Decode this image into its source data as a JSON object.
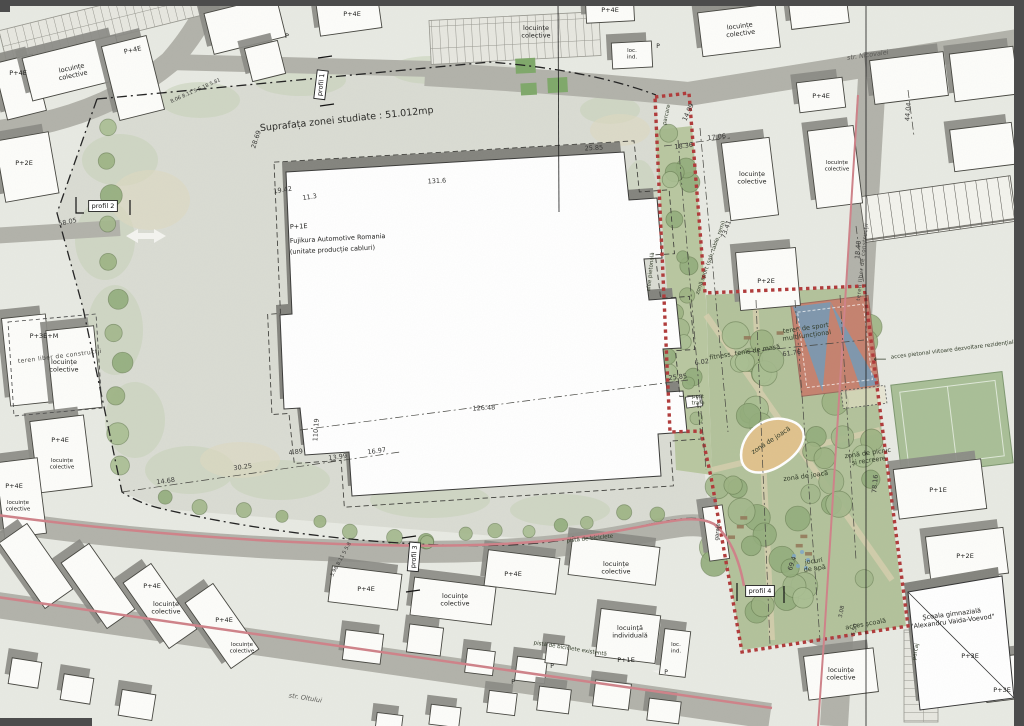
{
  "map": {
    "colors": {
      "boundary_red": "#b03a3a",
      "study_line": "#222222",
      "park_green": "#b3c29b",
      "tree_green": "#9db383",
      "road_gray": "#b2b2aa",
      "bike_path_pink": "#cf8289",
      "building_white": "#fdfdfa",
      "shadow_gray": "#8b8b85",
      "sand_tan": "#e0c28d",
      "sport_red": "#c5826f",
      "sport_blue": "#7f97ad"
    },
    "labels": [
      {
        "t": "Suprafața zonei studiate : 51.012mp",
        "x": 347,
        "y": 122,
        "rot": -6,
        "size": 9.5,
        "cls": "title",
        "name": "study-area-label"
      },
      {
        "t": "P+1E",
        "x": 290,
        "y": 229,
        "rot": -3,
        "anchor": "start",
        "cls": "bldg"
      },
      {
        "t": "Fujikura Automotive Romania",
        "x": 290,
        "y": 243,
        "rot": -3,
        "anchor": "start",
        "cls": "bldg",
        "name": "factory-name"
      },
      {
        "t": "(unitate producție cabluri)",
        "x": 290,
        "y": 254,
        "rot": -3,
        "anchor": "start",
        "cls": "bldg"
      },
      {
        "t": "str. Nicovalei",
        "x": 868,
        "y": 57,
        "rot": -8,
        "cls": "street",
        "name": "street-name-nicovalei"
      },
      {
        "t": "str. Oltului",
        "x": 305,
        "y": 700,
        "rot": 9,
        "cls": "street",
        "name": "street-name-oltului"
      },
      {
        "t": "profil 1",
        "x": 323,
        "y": 85,
        "rot": -83,
        "cls": "profil",
        "boxed": true,
        "name": "profile-marker-1"
      },
      {
        "t": "profil 2",
        "x": 103,
        "y": 208,
        "cls": "profil",
        "boxed": true,
        "name": "profile-marker-2"
      },
      {
        "t": "profil 3",
        "x": 416,
        "y": 557,
        "rot": -85,
        "cls": "profil",
        "boxed": true,
        "name": "profile-marker-3"
      },
      {
        "t": "profil 4",
        "x": 760,
        "y": 593,
        "cls": "profil",
        "boxed": true,
        "name": "profile-marker-4"
      },
      {
        "t": "P+4E",
        "x": 18,
        "y": 75,
        "cls": "bldg"
      },
      {
        "t": "locuințe\ncolective",
        "x": 72,
        "y": 70,
        "rot": -12,
        "cls": "bldg"
      },
      {
        "t": "P+4E",
        "x": 133,
        "y": 52,
        "rot": -12,
        "cls": "bldg"
      },
      {
        "t": "P",
        "x": 287,
        "y": 38,
        "cls": "bldg"
      },
      {
        "t": "P+4E",
        "x": 352,
        "y": 16,
        "cls": "bldg"
      },
      {
        "t": "locuințe\ncolective",
        "x": 536,
        "y": 30,
        "cls": "bldg"
      },
      {
        "t": "P+4E",
        "x": 610,
        "y": 12,
        "cls": "bldg"
      },
      {
        "t": "loc.\nind.",
        "x": 632,
        "y": 52,
        "size": 5.5,
        "cls": "bldg"
      },
      {
        "t": "P",
        "x": 658,
        "y": 48,
        "size": 6,
        "cls": "bldg"
      },
      {
        "t": "locuințe\ncolective",
        "x": 740,
        "y": 28,
        "rot": -7,
        "cls": "bldg"
      },
      {
        "t": "P+4E",
        "x": 821,
        "y": 98,
        "cls": "bldg"
      },
      {
        "t": "locuințe\ncolective",
        "x": 752,
        "y": 176,
        "cls": "bldg"
      },
      {
        "t": "locuințe\ncolective",
        "x": 837,
        "y": 164,
        "size": 5.5,
        "cls": "bldg"
      },
      {
        "t": "44.04",
        "x": 910,
        "y": 112,
        "rot": -85,
        "cls": "dim"
      },
      {
        "t": "P+2E",
        "x": 24,
        "y": 165,
        "cls": "bldg"
      },
      {
        "t": "teren liber de construcții",
        "x": 60,
        "y": 358,
        "rot": -7,
        "size": 6,
        "cls": "area"
      },
      {
        "t": "P+3E+M",
        "x": 44,
        "y": 338,
        "cls": "bldg"
      },
      {
        "t": "locuințe\ncolective",
        "x": 64,
        "y": 364,
        "cls": "bldg"
      },
      {
        "t": "P+4E",
        "x": 60,
        "y": 442,
        "cls": "bldg"
      },
      {
        "t": "locuințe\ncolective",
        "x": 62,
        "y": 462,
        "size": 5.5,
        "cls": "bldg"
      },
      {
        "t": "P+4E",
        "x": 14,
        "y": 488,
        "cls": "bldg"
      },
      {
        "t": "locuințe\ncolective",
        "x": 18,
        "y": 504,
        "size": 5.5,
        "cls": "bldg"
      },
      {
        "t": "28.69",
        "x": 258,
        "y": 140,
        "rot": -72,
        "cls": "dim"
      },
      {
        "t": "19.42",
        "x": 283,
        "y": 192,
        "rot": -9,
        "cls": "dim"
      },
      {
        "t": "11.3",
        "x": 310,
        "y": 199,
        "rot": -9,
        "cls": "dim"
      },
      {
        "t": "58.05",
        "x": 68,
        "y": 224,
        "rot": -12,
        "cls": "dim"
      },
      {
        "t": "131.6",
        "x": 437,
        "y": 183,
        "rot": -3,
        "cls": "dim"
      },
      {
        "t": "25.85",
        "x": 594,
        "y": 150,
        "rot": -3,
        "cls": "dim"
      },
      {
        "t": "126.48",
        "x": 484,
        "y": 410,
        "rot": -3,
        "cls": "dim"
      },
      {
        "t": "110.19",
        "x": 318,
        "y": 430,
        "rot": -86,
        "cls": "dim"
      },
      {
        "t": "14.68",
        "x": 166,
        "y": 483,
        "rot": -8,
        "cls": "dim"
      },
      {
        "t": "30.25",
        "x": 243,
        "y": 469,
        "rot": -8,
        "cls": "dim"
      },
      {
        "t": "4.89",
        "x": 296,
        "y": 454,
        "rot": -8,
        "cls": "dim"
      },
      {
        "t": "13.99",
        "x": 338,
        "y": 459,
        "rot": -8,
        "cls": "dim"
      },
      {
        "t": "16.97",
        "x": 377,
        "y": 453,
        "rot": -8,
        "cls": "dim"
      },
      {
        "t": "25.85",
        "x": 678,
        "y": 379,
        "rot": -6,
        "cls": "dim"
      },
      {
        "t": "61.76",
        "x": 792,
        "y": 355,
        "rot": -8,
        "cls": "dim"
      },
      {
        "t": "6.02",
        "x": 702,
        "y": 364,
        "rot": -8,
        "cls": "dim"
      },
      {
        "t": "8.06  8.11  5  5.18  5.81",
        "x": 196,
        "y": 92,
        "rot": -24,
        "size": 5,
        "cls": "dim"
      },
      {
        "t": "5.98  8.11  5  5.8",
        "x": 342,
        "y": 560,
        "rot": -62,
        "size": 5,
        "cls": "dim"
      },
      {
        "t": "18.36",
        "x": 684,
        "y": 148,
        "rot": -8,
        "cls": "dim"
      },
      {
        "t": "17.06",
        "x": 717,
        "y": 139,
        "rot": -8,
        "cls": "dim"
      },
      {
        "t": "14.99",
        "x": 690,
        "y": 113,
        "rot": -65,
        "cls": "dim"
      },
      {
        "t": "73.41",
        "x": 728,
        "y": 230,
        "rot": -70,
        "cls": "dim"
      },
      {
        "t": "18.40",
        "x": 860,
        "y": 250,
        "rot": -85,
        "cls": "dim"
      },
      {
        "t": "78.16",
        "x": 877,
        "y": 484,
        "rot": -85,
        "cls": "dim"
      },
      {
        "t": "69.4",
        "x": 794,
        "y": 564,
        "rot": -72,
        "cls": "dim"
      },
      {
        "t": "3.08",
        "x": 843,
        "y": 612,
        "rot": -78,
        "size": 5.5,
        "cls": "dim"
      },
      {
        "t": "5.50",
        "x": 856,
        "y": 630,
        "rot": -78,
        "size": 5.5,
        "cls": "dim"
      },
      {
        "t": "parcare",
        "x": 668,
        "y": 115,
        "rot": -78,
        "size": 5.5,
        "cls": "park"
      },
      {
        "t": "alee pietonală",
        "x": 652,
        "y": 272,
        "rot": -84,
        "size": 5.5,
        "cls": "park"
      },
      {
        "t": "zonă sport (șah, table, remi)",
        "x": 712,
        "y": 258,
        "rot": -70,
        "size": 5.5,
        "cls": "park"
      },
      {
        "t": "fitness, tenis de masă",
        "x": 745,
        "y": 354,
        "rot": -9,
        "cls": "park"
      },
      {
        "t": "teren de sport\nmultifuncțional",
        "x": 806,
        "y": 330,
        "rot": -8,
        "cls": "park"
      },
      {
        "t": "post\ntrafo",
        "x": 698,
        "y": 398,
        "size": 5.5,
        "cls": "park"
      },
      {
        "t": "zonă de joacă",
        "x": 772,
        "y": 442,
        "rot": -33,
        "cls": "park"
      },
      {
        "t": "zonă de joacă",
        "x": 806,
        "y": 478,
        "rot": -8,
        "cls": "park"
      },
      {
        "t": "zonă de picnic\nși recreere",
        "x": 868,
        "y": 455,
        "rot": -8,
        "cls": "park"
      },
      {
        "t": "jocuri\nde apă",
        "x": 814,
        "y": 563,
        "rot": -8,
        "cls": "park"
      },
      {
        "t": "acces școală",
        "x": 866,
        "y": 626,
        "rot": -10,
        "cls": "park"
      },
      {
        "t": "parcaj",
        "x": 917,
        "y": 652,
        "rot": -80,
        "size": 5.5,
        "cls": "park"
      },
      {
        "t": "garaje",
        "x": 719,
        "y": 532,
        "rot": -85,
        "size": 5.5,
        "cls": "bldg"
      },
      {
        "t": "pistă de biciclete",
        "x": 590,
        "y": 540,
        "rot": -6,
        "size": 5.5,
        "cls": "park"
      },
      {
        "t": "pistă de biciclete existentă",
        "x": 570,
        "y": 650,
        "rot": 9,
        "size": 5.5,
        "cls": "park"
      },
      {
        "t": "teren liber de construcții",
        "x": 864,
        "y": 262,
        "rot": -84,
        "size": 5.5,
        "cls": "area"
      },
      {
        "t": "acces pietonal viitoare dezvoltare rezidențială",
        "x": 954,
        "y": 351,
        "rot": -7,
        "size": 5.5,
        "cls": "park",
        "name": "access-note"
      },
      {
        "t": "⟵",
        "x": 880,
        "y": 362,
        "size": 9,
        "cls": "park",
        "name": "arrow-west-icon"
      },
      {
        "t": "Școala gimnazială\n\"Alexandru Vaida-Voevod\"",
        "x": 952,
        "y": 616,
        "rot": -7,
        "cls": "bldg",
        "name": "school-name"
      },
      {
        "t": "P+3E",
        "x": 970,
        "y": 658,
        "cls": "bldg"
      },
      {
        "t": "P+3E",
        "x": 1002,
        "y": 692,
        "cls": "bldg"
      },
      {
        "t": "locuințe\ncolective",
        "x": 841,
        "y": 672,
        "cls": "bldg"
      },
      {
        "t": "P+1E",
        "x": 938,
        "y": 492,
        "cls": "bldg"
      },
      {
        "t": "P+2E",
        "x": 965,
        "y": 558,
        "cls": "bldg"
      },
      {
        "t": "P+2E",
        "x": 766,
        "y": 283,
        "cls": "bldg"
      },
      {
        "t": "P+4E",
        "x": 513,
        "y": 576,
        "cls": "bldg"
      },
      {
        "t": "locuințe\ncolective",
        "x": 455,
        "y": 598,
        "cls": "bldg"
      },
      {
        "t": "locuințe\ncolective",
        "x": 616,
        "y": 566,
        "cls": "bldg"
      },
      {
        "t": "P+4E",
        "x": 366,
        "y": 591,
        "cls": "bldg"
      },
      {
        "t": "locuință\nindividuală",
        "x": 630,
        "y": 630,
        "cls": "bldg"
      },
      {
        "t": "P+1E",
        "x": 626,
        "y": 662,
        "cls": "bldg"
      },
      {
        "t": "loc.\nind.",
        "x": 676,
        "y": 646,
        "size": 5.5,
        "cls": "bldg"
      },
      {
        "t": "P",
        "x": 666,
        "y": 674,
        "size": 6,
        "cls": "bldg"
      },
      {
        "t": "P",
        "x": 552,
        "y": 668,
        "size": 6,
        "cls": "bldg"
      },
      {
        "t": "P",
        "x": 513,
        "y": 684,
        "size": 6,
        "cls": "bldg"
      },
      {
        "t": "P+4E",
        "x": 152,
        "y": 588,
        "cls": "bldg"
      },
      {
        "t": "locuințe\ncolective",
        "x": 166,
        "y": 606,
        "cls": "bldg"
      },
      {
        "t": "P+4E",
        "x": 224,
        "y": 622,
        "cls": "bldg"
      },
      {
        "t": "locuințe\ncolective",
        "x": 242,
        "y": 646,
        "size": 5.5,
        "cls": "bldg"
      }
    ]
  }
}
